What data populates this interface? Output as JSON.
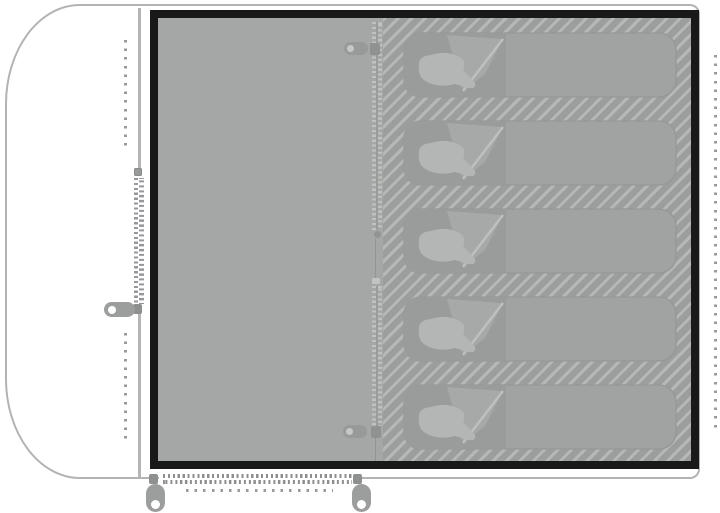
{
  "diagram": {
    "kind": "tent-floor-plan",
    "sleeping_bag_count": 5,
    "sleeping_area": "hatched cabin on right side",
    "living_area": "plain grey floor on left side",
    "vestibule": "white porch area outside cabin, left",
    "zippers": {
      "vestibule_side_door": {
        "orientation": "vertical",
        "pulls": 1
      },
      "front_door": {
        "orientation": "horizontal",
        "pulls": 2
      },
      "inner_divider": {
        "orientation": "vertical",
        "pulls": 2
      }
    },
    "colors": {
      "background": "#ffffff",
      "outline": "#b2b4b3",
      "stitch": "#999b9a",
      "floor": "#a5a7a6",
      "floor_border": "#191919",
      "hatch_stripe": "#b6b8b5",
      "hatch_base": "#9c9e9d",
      "zipper_teeth": "#8d8f8e",
      "zipper_pull": "#9c9e9d",
      "bag_body": "#a1a3a2",
      "bag_hood": "#9a9c9b",
      "bag_pillow": "#b4b6b5"
    }
  }
}
